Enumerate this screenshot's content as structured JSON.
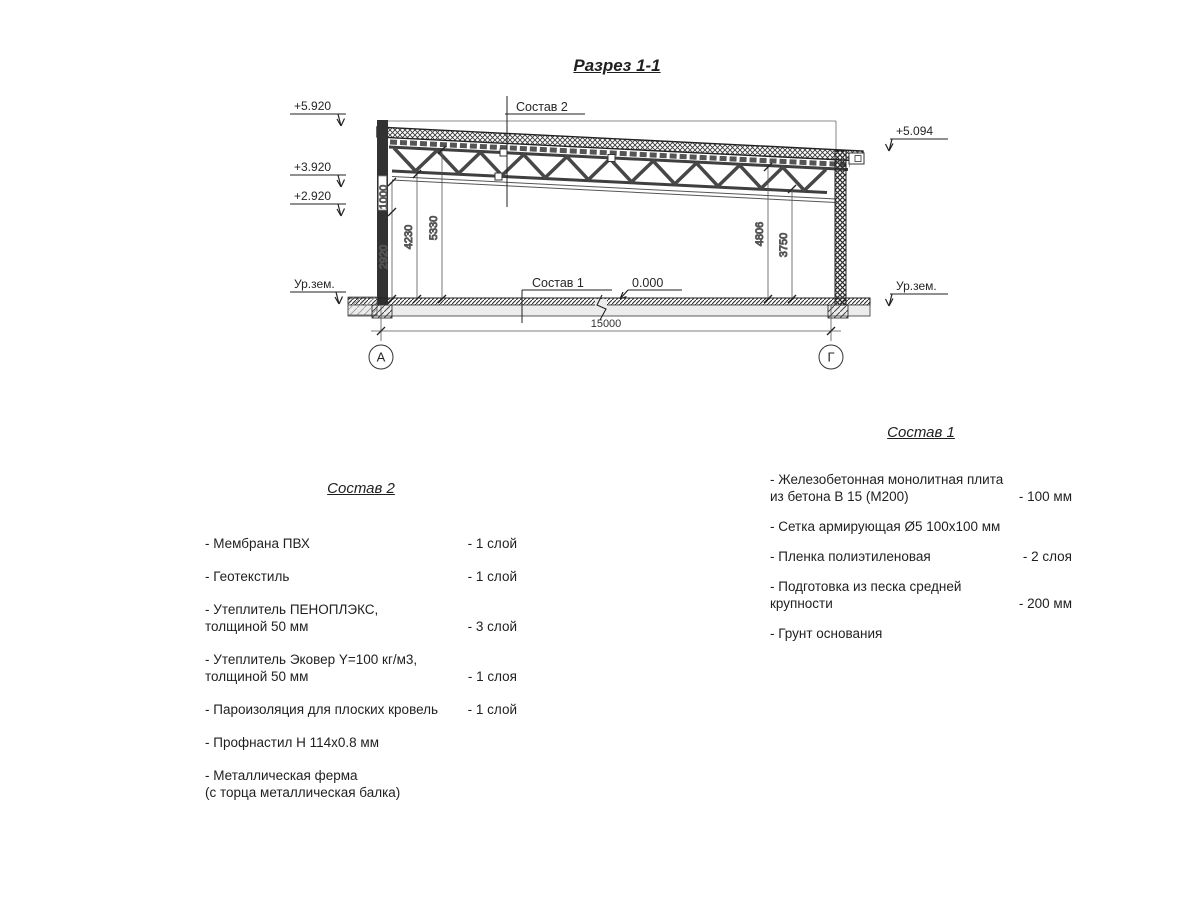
{
  "title": "Разрез 1-1",
  "drawing": {
    "elevations_left": [
      "+5.920",
      "+3.920",
      "+2.920",
      "Ур.зем."
    ],
    "elevation_right": "+5.094",
    "ground_right": "Ур.зем.",
    "leader_sostav2": "Состав 2",
    "leader_sostav1": "Состав 1",
    "level_zero": "0.000",
    "dim_1000": "1000",
    "dim_2920": "2920",
    "dim_4230": "4230",
    "dim_5330": "5330",
    "dim_4806": "4806",
    "dim_3750": "3750",
    "dim_span": "15000",
    "axis_left": "А",
    "axis_right": "Г"
  },
  "sostav2": {
    "heading": "Состав 2",
    "items": [
      {
        "line1": "- Мембрана ПВХ",
        "line2": "",
        "value": "- 1 слой"
      },
      {
        "line1": "- Геотекстиль",
        "line2": "",
        "value": "- 1 слой"
      },
      {
        "line1": "- Утеплитель ПЕНОПЛЭКС,",
        "line2": "толщиной 50 мм",
        "value": "- 3 слой"
      },
      {
        "line1": "- Утеплитель Эковер Y=100 кг/м3,",
        "line2": "толщиной 50 мм",
        "value": "- 1 слоя"
      },
      {
        "line1": "- Пароизоляция для плоских кровель",
        "line2": "",
        "value": "- 1 слой"
      },
      {
        "line1": "- Профнастил Н 114х0.8 мм",
        "line2": "",
        "value": ""
      },
      {
        "line1": "- Металлическая ферма",
        "line2": "(с торца металлическая балка)",
        "value": ""
      }
    ]
  },
  "sostav1": {
    "heading": "Состав 1",
    "items": [
      {
        "line1": "- Железобетонная  монолитная плита",
        "line2": "из бетона В 15 (М200)",
        "value": "- 100 мм"
      },
      {
        "line1": "- Сетка армирующая Ø5 100х100 мм",
        "line2": "",
        "value": ""
      },
      {
        "line1": "- Пленка полиэтиленовая",
        "line2": "",
        "value": "-  2 слоя"
      },
      {
        "line1": "- Подготовка из песка средней",
        "line2": "крупности",
        "value": "- 200 мм"
      },
      {
        "line1": "- Грунт основания",
        "line2": "",
        "value": ""
      }
    ]
  }
}
